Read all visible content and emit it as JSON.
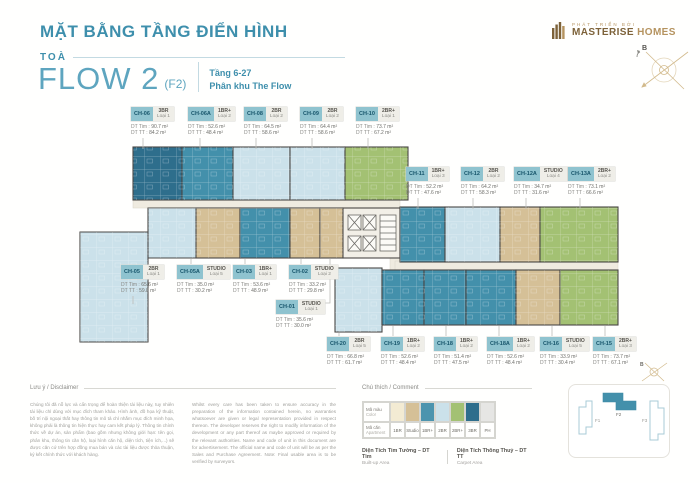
{
  "header": {
    "title": "MẶT BẰNG TẦNG ĐIỂN HÌNH",
    "tower_label": "TOÀ",
    "tower_name": "FLOW 2",
    "tower_code": "(F2)",
    "floors": "Tầng 6-27",
    "zone": "Phân khu The Flow",
    "developer_tagline": "PHÁT TRIỂN BỞI",
    "brand_name": "MASTERISE",
    "brand_suffix": "HOMES",
    "compass_label": "B"
  },
  "plan": {
    "dt_tim_label": "DT Tim :",
    "dt_tt_label": "DT TT :",
    "units": [
      {
        "code": "CH-06",
        "type": "3BR",
        "variant": "Loại 1",
        "dt_tim": "90.7 m²",
        "dt_tt": "84.2 m²",
        "color": "3br"
      },
      {
        "code": "CH-06A",
        "type": "1BR+",
        "variant": "Loại 2",
        "dt_tim": "52.6 m²",
        "dt_tt": "48.4 m²",
        "color": "1br_plus"
      },
      {
        "code": "CH-08",
        "type": "2BR",
        "variant": "Loại 2",
        "dt_tim": "64.5 m²",
        "dt_tt": "58.6 m²",
        "color": "2br"
      },
      {
        "code": "CH-09",
        "type": "2BR",
        "variant": "Loại 2",
        "dt_tim": "64.4 m²",
        "dt_tt": "58.6 m²",
        "color": "2br"
      },
      {
        "code": "CH-10",
        "type": "2BR+",
        "variant": "Loại 1",
        "dt_tim": "73.7 m²",
        "dt_tt": "67.2 m²",
        "color": "2br_plus"
      },
      {
        "code": "CH-05",
        "type": "2BR",
        "variant": "Loại 1",
        "dt_tim": "65.6 m²",
        "dt_tt": "59.8 m²",
        "color": "2br"
      },
      {
        "code": "CH-05A",
        "type": "STUDIO",
        "variant": "Loại 5",
        "dt_tim": "35.0 m²",
        "dt_tt": "30.2 m²",
        "color": "studio"
      },
      {
        "code": "CH-03",
        "type": "1BR+",
        "variant": "Loại 1",
        "dt_tim": "53.6 m²",
        "dt_tt": "48.9 m²",
        "color": "1br_plus"
      },
      {
        "code": "CH-02",
        "type": "STUDIO",
        "variant": "Loại 2",
        "dt_tim": "33.2 m²",
        "dt_tt": "29.8 m²",
        "color": "studio"
      },
      {
        "code": "CH-01",
        "type": "STUDIO",
        "variant": "Loại 1",
        "dt_tim": "35.6 m²",
        "dt_tt": "30.0 m²",
        "color": "studio"
      },
      {
        "code": "CH-11",
        "type": "1BR+",
        "variant": "Loại 3",
        "dt_tim": "52.2 m²",
        "dt_tt": "47.6 m²",
        "color": "1br_plus"
      },
      {
        "code": "CH-12",
        "type": "2BR",
        "variant": "Loại 2",
        "dt_tim": "64.2 m²",
        "dt_tt": "58.3 m²",
        "color": "2br"
      },
      {
        "code": "CH-12A",
        "type": "STUDIO",
        "variant": "Loại 4",
        "dt_tim": "34.7 m²",
        "dt_tt": "31.6 m²",
        "color": "studio"
      },
      {
        "code": "CH-13A",
        "type": "2BR+",
        "variant": "Loại 2",
        "dt_tim": "73.1 m²",
        "dt_tt": "66.6 m²",
        "color": "2br_plus"
      },
      {
        "code": "CH-20",
        "type": "2BR",
        "variant": "Loại 5",
        "dt_tim": "66.8 m²",
        "dt_tt": "61.7 m²",
        "color": "2br"
      },
      {
        "code": "CH-19",
        "type": "1BR+",
        "variant": "Loại 2",
        "dt_tim": "52.6 m²",
        "dt_tt": "48.4 m²",
        "color": "1br_plus"
      },
      {
        "code": "CH-18",
        "type": "1BR+",
        "variant": "Loại 2",
        "dt_tim": "51.4 m²",
        "dt_tt": "47.5 m²",
        "color": "1br_plus"
      },
      {
        "code": "CH-18A",
        "type": "1BR+",
        "variant": "Loại 2",
        "dt_tim": "52.6 m²",
        "dt_tt": "48.4 m²",
        "color": "1br_plus"
      },
      {
        "code": "CH-16",
        "type": "STUDIO",
        "variant": "Loại 5",
        "dt_tim": "33.9 m²",
        "dt_tt": "30.4 m²",
        "color": "studio"
      },
      {
        "code": "CH-15",
        "type": "2BR+",
        "variant": "Loại 3",
        "dt_tim": "73.7 m²",
        "dt_tt": "67.1 m²",
        "color": "2br_plus"
      }
    ]
  },
  "legend": {
    "heading": "Chú thích / Comment",
    "row1_label": "Mã màu",
    "row1_sub": "Color",
    "row2_label": "Mã căn",
    "row2_sub": "Apartment",
    "items": [
      {
        "label": "1BR",
        "color": "#F3EBD3"
      },
      {
        "label": "Studio",
        "color": "#D5C097"
      },
      {
        "label": "1BR+",
        "color": "#4C94AE"
      },
      {
        "label": "2BR",
        "color": "#CBE1EA"
      },
      {
        "label": "2BR+",
        "color": "#A3C173"
      },
      {
        "label": "3BR",
        "color": "#2E6E8C"
      },
      {
        "label": "PH",
        "color": "#E6E6E4"
      }
    ],
    "area_terms": [
      {
        "vi": "Diện Tích Tim Tường – DT Tim",
        "en": "Built-up Area"
      },
      {
        "vi": "Diện Tích Thông Thuỷ – DT TT",
        "en": "Carpet Area"
      }
    ]
  },
  "disclaimer": {
    "heading": "Lưu ý / Disclaimer",
    "vi": "Chúng tôi đã nỗ lực và cẩn trọng để hoàn thiện tài liệu này, tuy nhiên tài liệu chỉ dùng với mục đích tham khảo. Hình ảnh, đồ họa kỹ thuật, bố trí nội ngoại thất hay thông tin mô tả chỉ nhằm mục đích minh họa, không phải là thông tin hiện thực hay cam kết pháp lý. Thông tin chính thức về dự án, sản phẩm (bao gồm nhưng không giới hạn: tên gọi, phân khu, thông tin căn hộ, loại hình căn hộ, diện tích, tiện ích,...) sẽ được căn cứ trên hợp đồng mua bán và các tài liệu được thỏa thuận, ký kết chính thức với khách hàng.",
    "en": "Whilst every care has been taken to ensure accuracy in the preparation of the information contained herein, no warranties whatsoever are given or legal representation provided in respect thereon. The developer reserves the right to modify information of the development or any part thereof as maybe approved or required by the relevant authorities. Name and code of unit in this document are for advertisement. The official name and code of unit will be as per the Sales and Purchase Agreement. Note: Final usable area is to be verified by surveyors."
  },
  "keyplan": {
    "towers": [
      "F1",
      "F2",
      "F3"
    ],
    "active": "F2"
  },
  "palette": {
    "accent": "#3E8FAC",
    "accent_light": "#5EA5BF",
    "gold": "#B5935F",
    "gold_dark": "#7D6239",
    "chip": "#8FC3CF",
    "1br": "#F3EBD3",
    "studio": "#D5C097",
    "1br_plus": "#4390AB",
    "2br": "#CBE1EA",
    "2br_plus": "#A3C173",
    "3br": "#2E6E8C",
    "ph": "#E6E6E4",
    "corridor": "#EFEBE0"
  }
}
